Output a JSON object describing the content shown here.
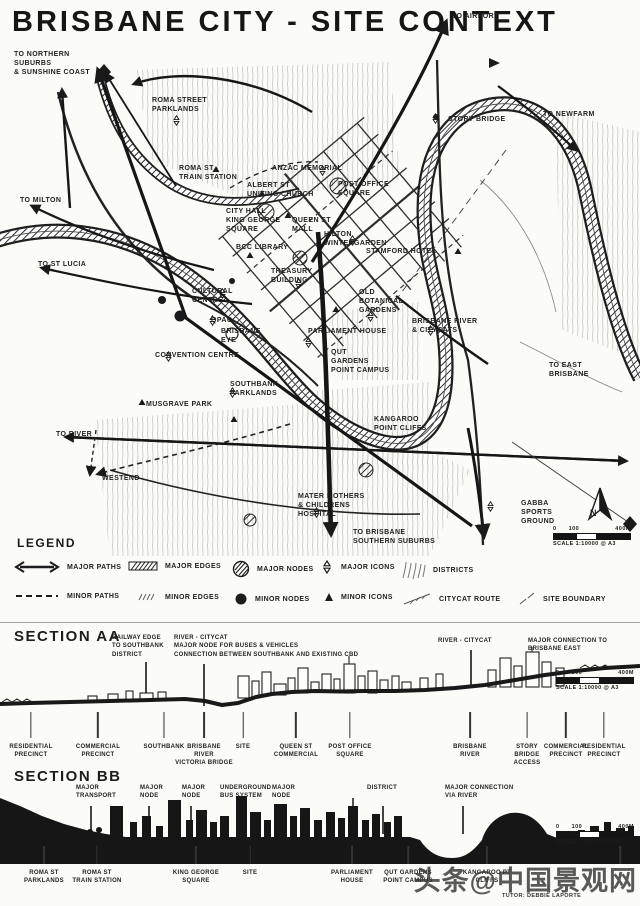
{
  "title": "BRISBANE CITY - SITE CONTEXT",
  "colors": {
    "ink": "#1d1d1d",
    "paper": "#fbfbf8",
    "pencil": "#8a8a8a",
    "watermark": "#343434"
  },
  "watermark": "头条@中国景观网",
  "scalebar": {
    "start": "0",
    "mid": "100",
    "end": "400M",
    "caption": "SCALE 1:10000 @ A3"
  },
  "map": {
    "compass_label": "N",
    "labels": [
      {
        "text": "TO NORTHERN\nSUBURBS\n& SUNSHINE COAST",
        "x": 14,
        "y": 50
      },
      {
        "text": "TO AIRPORT",
        "x": 452,
        "y": 12
      },
      {
        "text": "TO NEWFARM",
        "x": 543,
        "y": 110
      },
      {
        "text": "ROMA STREET\nPARKLANDS",
        "x": 152,
        "y": 96
      },
      {
        "text": "STORY BRIDGE",
        "x": 448,
        "y": 115
      },
      {
        "text": "ROMA ST\nTRAIN STATION",
        "x": 179,
        "y": 164
      },
      {
        "text": "ANZAC MEMORIAL",
        "x": 272,
        "y": 164
      },
      {
        "text": "ALBERT ST\nUNITING CHURCH",
        "x": 247,
        "y": 181
      },
      {
        "text": "POST OFFICE\nSQUARE",
        "x": 338,
        "y": 180
      },
      {
        "text": "TO MILTON",
        "x": 20,
        "y": 196
      },
      {
        "text": "CITY HALL\nKING GEORGE\nSQUARE",
        "x": 226,
        "y": 207
      },
      {
        "text": "QUEEN ST\nMALL",
        "x": 292,
        "y": 216
      },
      {
        "text": "HILTON\nWINTERGARDEN",
        "x": 324,
        "y": 230
      },
      {
        "text": "STAMFORD HOTEL",
        "x": 366,
        "y": 247
      },
      {
        "text": "BCC LIBRARY",
        "x": 236,
        "y": 243
      },
      {
        "text": "TO ST LUCIA",
        "x": 38,
        "y": 260
      },
      {
        "text": "TREASURY\nBUILDING",
        "x": 271,
        "y": 267
      },
      {
        "text": "OLD\nBOTANICAL\nGARDENS",
        "x": 359,
        "y": 288
      },
      {
        "text": "CULTURAL\nCENTRE",
        "x": 192,
        "y": 287
      },
      {
        "text": "QPAC",
        "x": 211,
        "y": 316
      },
      {
        "text": "BRISBANE RIVER\n& CITYCATS",
        "x": 412,
        "y": 317
      },
      {
        "text": "PARLIAMENT HOUSE",
        "x": 308,
        "y": 327
      },
      {
        "text": "BRISBANE\nEYE",
        "x": 221,
        "y": 327
      },
      {
        "text": "QUT\nGARDENS\nPOINT CAMPUS",
        "x": 331,
        "y": 348
      },
      {
        "text": "CONVENTION CENTRE",
        "x": 155,
        "y": 351
      },
      {
        "text": "SOUTHBANK\nPARKLANDS",
        "x": 230,
        "y": 380
      },
      {
        "text": "TO EAST\nBRISBANE",
        "x": 549,
        "y": 361
      },
      {
        "text": "MUSGRAVE PARK",
        "x": 146,
        "y": 400
      },
      {
        "text": "KANGAROO\nPOINT CLIFFS",
        "x": 374,
        "y": 415
      },
      {
        "text": "TO RIVER",
        "x": 56,
        "y": 430
      },
      {
        "text": "WESTEND",
        "x": 102,
        "y": 474
      },
      {
        "text": "MATER MOTHERS\n& CHILDRENS\nHOSPITAL",
        "x": 298,
        "y": 492
      },
      {
        "text": "GABBA\nSPORTS\nGROUND",
        "x": 521,
        "y": 499
      },
      {
        "text": "TO BRISBANE\nSOUTHERN SUBURBS",
        "x": 353,
        "y": 528
      }
    ]
  },
  "legend": {
    "title": "LEGEND",
    "row1": [
      {
        "icon": "double-arrow",
        "label": "MAJOR PATHS",
        "x": 14
      },
      {
        "icon": "hatched-bar",
        "label": "MAJOR EDGES",
        "x": 128
      },
      {
        "icon": "hatched-circle",
        "label": "MAJOR NODES",
        "x": 232
      },
      {
        "icon": "star",
        "label": "MAJOR ICONS",
        "x": 320
      },
      {
        "icon": "district-hatch",
        "label": "DISTRICTS",
        "x": 400
      }
    ],
    "row2": [
      {
        "icon": "dashed-line",
        "label": "MINOR PATHS",
        "x": 14
      },
      {
        "icon": "small-hatch",
        "label": "MINOR EDGES",
        "x": 136
      },
      {
        "icon": "filled-circle",
        "label": "MINOR NODES",
        "x": 234
      },
      {
        "icon": "small-triangle",
        "label": "MINOR ICONS",
        "x": 324
      },
      {
        "icon": "ticked-line",
        "label": "CITYCAT ROUTE",
        "x": 402
      },
      {
        "icon": "dash-diagonal",
        "label": "SITE BOUNDARY",
        "x": 518
      }
    ]
  },
  "section_aa": {
    "title": "SECTION AA",
    "annotations": [
      {
        "text": "RAILWAY EDGE\nTO SOUTHBANK\nDISTRICT",
        "x": 112,
        "y": 634
      },
      {
        "text": "RIVER - CITYCAT\nMAJOR NODE FOR BUSES & VEHICLES\nCONNECTION BETWEEN SOUTHBANK AND EXISTING CBD",
        "x": 174,
        "y": 634
      },
      {
        "text": "RIVER - CITYCAT",
        "x": 438,
        "y": 637
      },
      {
        "text": "MAJOR CONNECTION TO\nBRISBANE EAST",
        "x": 528,
        "y": 637
      }
    ],
    "ann_ticks": [
      {
        "x": 145,
        "y": 662,
        "h": 40
      },
      {
        "x": 203,
        "y": 664,
        "h": 42
      },
      {
        "x": 470,
        "y": 650,
        "h": 38
      },
      {
        "x": 532,
        "y": 652,
        "h": 24
      }
    ],
    "labels": [
      {
        "text": "RESIDENTIAL\nPRECINCT",
        "x": 31
      },
      {
        "text": "COMMERCIAL\nPRECINCT",
        "x": 98
      },
      {
        "text": "SOUTHBANK",
        "x": 164
      },
      {
        "text": "BRISBANE\nRIVER\nVICTORIA BRIDGE",
        "x": 204
      },
      {
        "text": "SITE",
        "x": 243
      },
      {
        "text": "QUEEN ST\nCOMMERCIAL",
        "x": 296
      },
      {
        "text": "POST OFFICE\nSQUARE",
        "x": 350
      },
      {
        "text": "BRISBANE\nRIVER",
        "x": 470
      },
      {
        "text": "STORY\nBRIDGE\nACCESS",
        "x": 527
      },
      {
        "text": "COMMERCIAL\nPRECINCT",
        "x": 566
      },
      {
        "text": "RESIDENTIAL\nPRECINCT",
        "x": 604
      }
    ]
  },
  "section_bb": {
    "title": "SECTION BB",
    "annotations": [
      {
        "text": "MAJOR\nTRANSPORT",
        "x": 76,
        "y": 784
      },
      {
        "text": "MAJOR\nNODE",
        "x": 140,
        "y": 784
      },
      {
        "text": "MAJOR\nNODE",
        "x": 182,
        "y": 784
      },
      {
        "text": "UNDERGROUND\nBUS SYSTEM",
        "x": 220,
        "y": 784
      },
      {
        "text": "MAJOR\nNODE",
        "x": 272,
        "y": 784
      },
      {
        "text": "DISTRICT",
        "x": 367,
        "y": 784
      },
      {
        "text": "MAJOR CONNECTION\nVIA RIVER",
        "x": 445,
        "y": 784
      }
    ],
    "ann_ticks": [
      {
        "x": 90,
        "y": 806,
        "h": 28
      },
      {
        "x": 148,
        "y": 806,
        "h": 28
      },
      {
        "x": 190,
        "y": 806,
        "h": 28
      },
      {
        "x": 238,
        "y": 806,
        "h": 28
      },
      {
        "x": 275,
        "y": 806,
        "h": 28
      },
      {
        "x": 382,
        "y": 806,
        "h": 28
      },
      {
        "x": 462,
        "y": 806,
        "h": 28
      }
    ],
    "labels": [
      {
        "text": "ROMA ST\nPARKLANDS",
        "x": 44
      },
      {
        "text": "ROMA ST\nTRAIN STATION",
        "x": 97
      },
      {
        "text": "KING GEORGE\nSQUARE",
        "x": 196
      },
      {
        "text": "SITE",
        "x": 250
      },
      {
        "text": "PARLIAMENT\nHOUSE",
        "x": 352
      },
      {
        "text": "QUT GARDENS\nPOINT CAMPUS",
        "x": 408
      },
      {
        "text": "KANGAROO PT\nCLIFFS",
        "x": 487
      },
      {
        "text": "",
        "x": 620
      }
    ],
    "tutor": "TUTOR: DEBBIE LAPORTE"
  }
}
